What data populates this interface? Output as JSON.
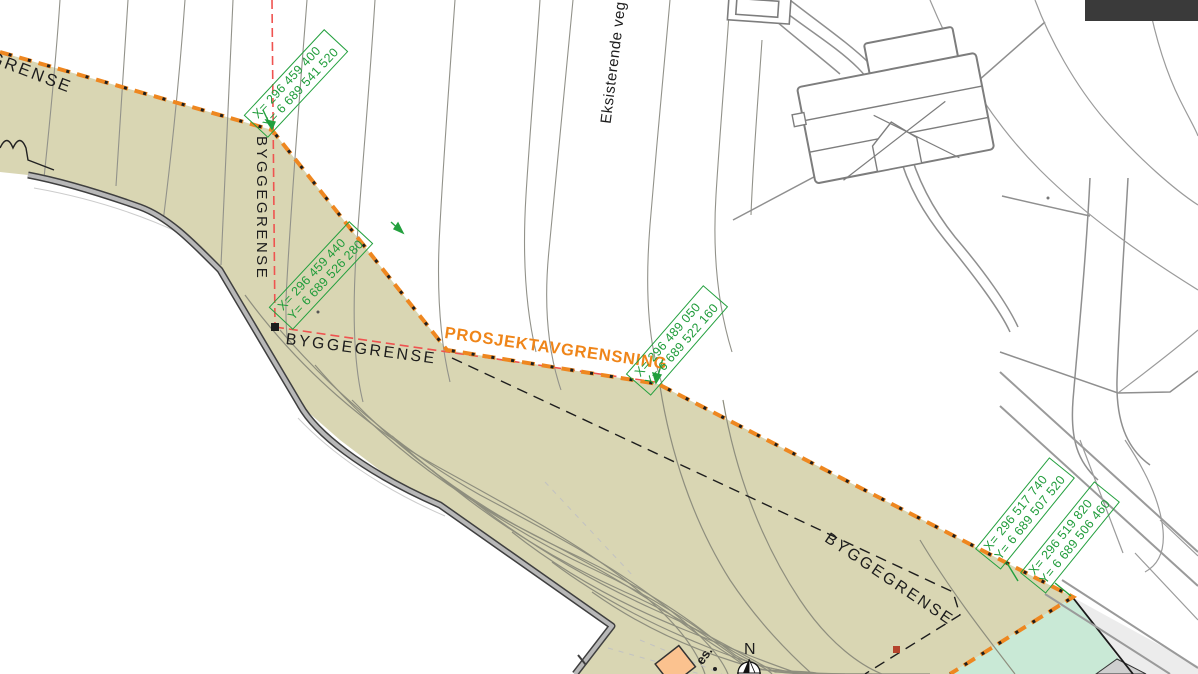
{
  "map": {
    "labels": {
      "grense_cut": "GRENSE",
      "byggegrense_vertical": "BYGGEGRENSE",
      "byggegrense_horizontal": "BYGGEGRENSE",
      "byggegrense_diagonal": "BYGGEGRENSE",
      "prosjektavgrensning": "PROSJEKTAVGRENSNING",
      "eksisterende_veg": "Eksisterende veg",
      "truncated_text": "es.",
      "north_letter": "N"
    },
    "coordinates": [
      {
        "x": "X= 296 459 400",
        "y": "Y= 6 689 541 520"
      },
      {
        "x": "X= 296 459 440",
        "y": "Y= 6 689 526 280"
      },
      {
        "x": "X= 296 489 050",
        "y": "Y= 6 689 522 160"
      },
      {
        "x": "X= 296 517 740",
        "y": "Y= 6 689 507 520"
      },
      {
        "x": "X= 296 519 820",
        "y": "Y= 6 689 506 460"
      }
    ],
    "colors": {
      "project_area_fill": "#d9d6b3",
      "project_line_orange": "#ee8720",
      "coordinate_green": "#23a03e",
      "reference_red_dash": "#ef5350",
      "green_strip_fill": "#c9e9d6",
      "contour_gray": "#92927f",
      "wall_gray": "#b8b8b8",
      "corner_rect_dark": "#3a3a3a",
      "building_peach": "#fbc28f"
    }
  }
}
